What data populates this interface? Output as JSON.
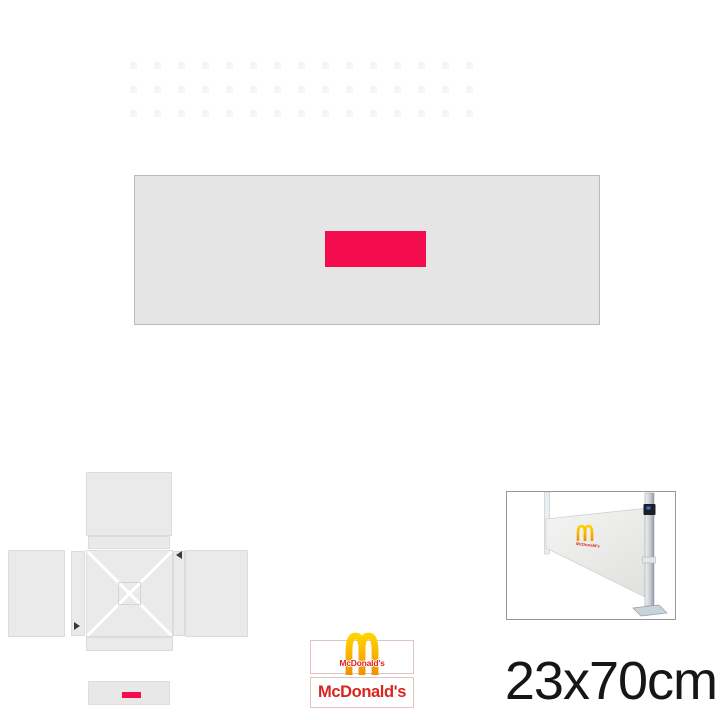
{
  "proof_sheet": {
    "size_label": "23x70cm",
    "brand": {
      "logo_caption": "McDonald's",
      "wordmark": "McDonald's",
      "photo_logo_text": "McDonald's"
    },
    "colors": {
      "print_accent": "#F30D4E",
      "mcdonalds_red": "#DA2420",
      "mcdonalds_gold": "#FBAB18",
      "banner_gray": "#E5E5E5",
      "panel_gray": "#EAEAEA"
    }
  }
}
